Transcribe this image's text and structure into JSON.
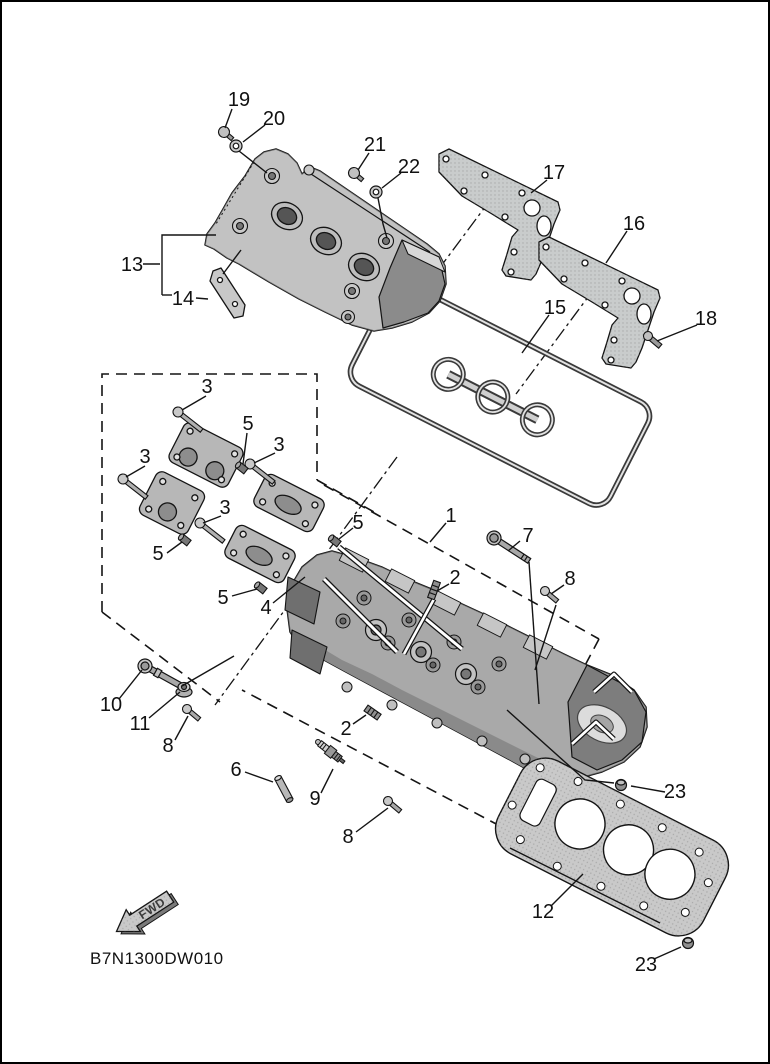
{
  "diagram": {
    "drawing_code": "B7N1300DW010",
    "fwd_label": "FWD",
    "palette": {
      "line": "#141414",
      "paper": "#ffffff",
      "part_light": "#c9c9c9",
      "part_mid": "#a9a9a9",
      "part_dark": "#6f6f6f"
    },
    "callouts": [
      {
        "n": "19"
      },
      {
        "n": "20"
      },
      {
        "n": "21"
      },
      {
        "n": "22"
      },
      {
        "n": "17"
      },
      {
        "n": "16"
      },
      {
        "n": "18"
      },
      {
        "n": "15"
      },
      {
        "n": "13"
      },
      {
        "n": "14"
      },
      {
        "n": "3"
      },
      {
        "n": "5"
      },
      {
        "n": "3"
      },
      {
        "n": "3"
      },
      {
        "n": "3"
      },
      {
        "n": "5"
      },
      {
        "n": "5"
      },
      {
        "n": "5"
      },
      {
        "n": "4"
      },
      {
        "n": "1"
      },
      {
        "n": "7"
      },
      {
        "n": "2"
      },
      {
        "n": "8"
      },
      {
        "n": "10"
      },
      {
        "n": "11"
      },
      {
        "n": "8"
      },
      {
        "n": "2"
      },
      {
        "n": "6"
      },
      {
        "n": "9"
      },
      {
        "n": "8"
      },
      {
        "n": "12"
      },
      {
        "n": "23"
      },
      {
        "n": "23"
      }
    ]
  }
}
